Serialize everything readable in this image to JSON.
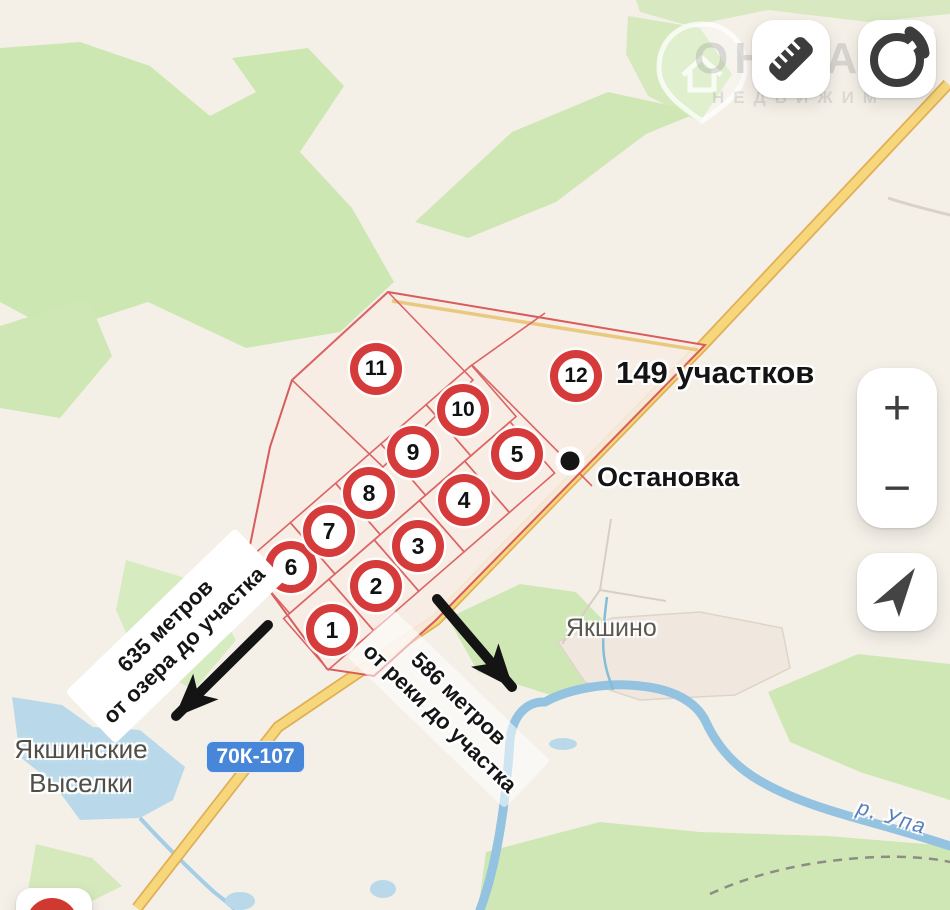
{
  "map_labels": {
    "plots_count": "149 участков",
    "bus_stop": "Остановка",
    "village_yakshino": "Якшино",
    "village_vyselki_line1": "Якшинские",
    "village_vyselki_line2": "Выселки",
    "river_name": "р. Упа",
    "road_badge": "70К-107",
    "distance_lake_line1": "635 метров",
    "distance_lake_line2": "от озера до участка",
    "distance_river_line1": "586 метров",
    "distance_river_line2": "от реки до участка"
  },
  "marker_labels": [
    "1",
    "2",
    "3",
    "4",
    "5",
    "6",
    "7",
    "8",
    "9",
    "10",
    "11",
    "12"
  ],
  "controls": {
    "zoom_in_glyph": "+",
    "zoom_out_glyph": "−"
  },
  "watermark": {
    "line1": "ОН ЕА",
    "line2": "НЕДВИЖИМ"
  },
  "colors": {
    "marker_red": "#d63b3b",
    "plot_outline_red": "#d85c5c",
    "road_yellow": "#f6d77c",
    "water_blue": "#b9d9ea",
    "river_blue": "#93c3e0",
    "forest_green": "#cfe7b4",
    "badge_blue": "#4886d9",
    "annotation_black": "#141414",
    "place_label_gray": "#5c5850",
    "water_label_blue": "#5580bb"
  }
}
